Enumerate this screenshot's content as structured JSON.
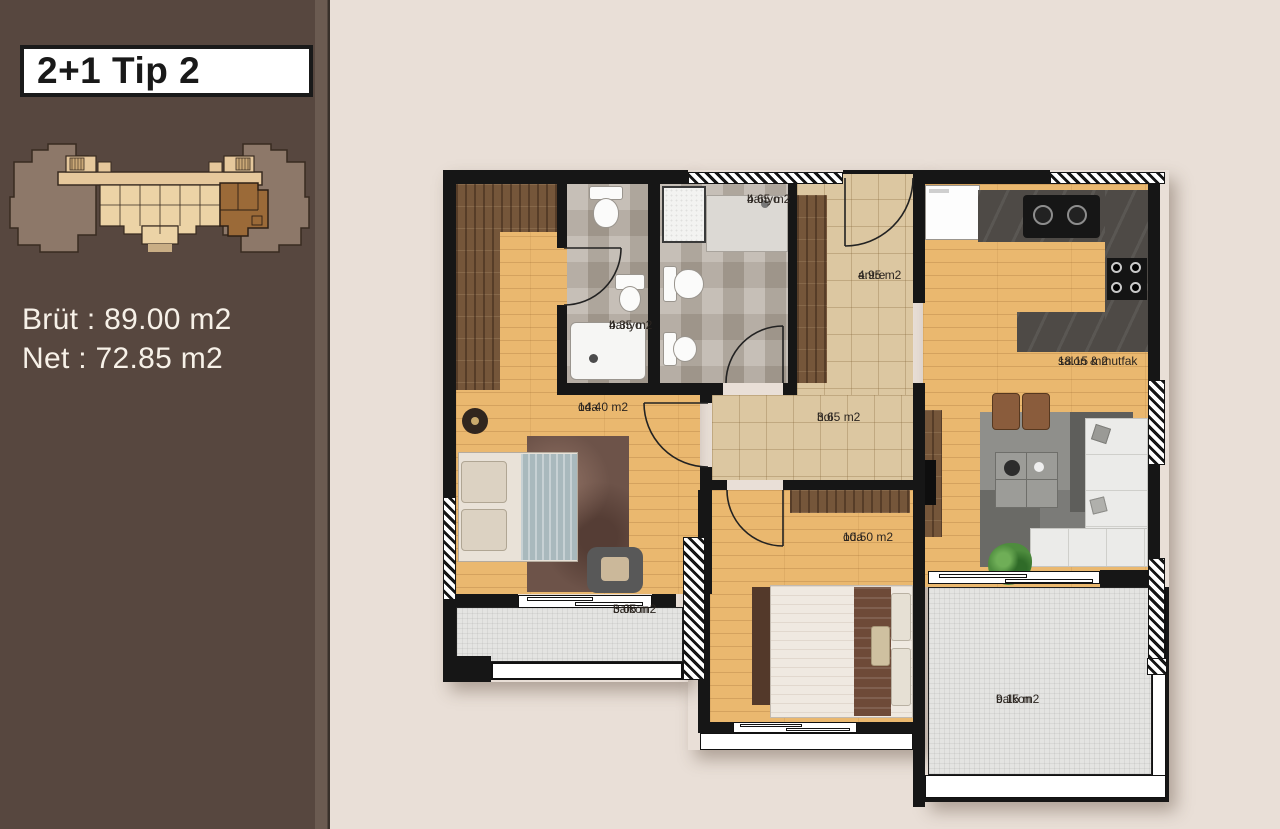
{
  "sidebar": {
    "title": "2+1 Tip 2",
    "brut_label": "Brüt : 89.00 m2",
    "net_label": "Net : 72.85 m2"
  },
  "plan": {
    "rooms": [
      {
        "id": "banyo-465",
        "name": "banyo",
        "area": "4.65 m2"
      },
      {
        "id": "banyo-435",
        "name": "banyo",
        "area": "4.35 m2"
      },
      {
        "id": "antre",
        "name": "antre",
        "area": "4.95 m2"
      },
      {
        "id": "hol",
        "name": "hol",
        "area": "3.65 m2"
      },
      {
        "id": "salon-mutfak",
        "name": "salon & mutfak",
        "area": "18.15 m2"
      },
      {
        "id": "oda-1440",
        "name": "oda",
        "area": "14.40 m2"
      },
      {
        "id": "oda-1050",
        "name": "oda",
        "area": "10.50 m2"
      },
      {
        "id": "balkon-305",
        "name": "balkon",
        "area": "3.05 m2"
      },
      {
        "id": "balkon-915",
        "name": "balkon",
        "area": "9.15 m2"
      }
    ]
  },
  "colors": {
    "canvas_bg": "#e9dfd7",
    "sidebar_bg": "#57473f",
    "sidebar_text": "#f7f1e8",
    "wall": "#161616",
    "wood_floor": "#eab86f",
    "tile_beige": "#dcc7a1",
    "tile_bath": "#b6ada2",
    "balcony_tile": "#e4e4e2",
    "counter": "#4e4a46",
    "key_mass": "#8d7869",
    "key_tan": "#ecd3a6",
    "key_highlight": "#9b6a38",
    "label_text": "#2b2520"
  }
}
